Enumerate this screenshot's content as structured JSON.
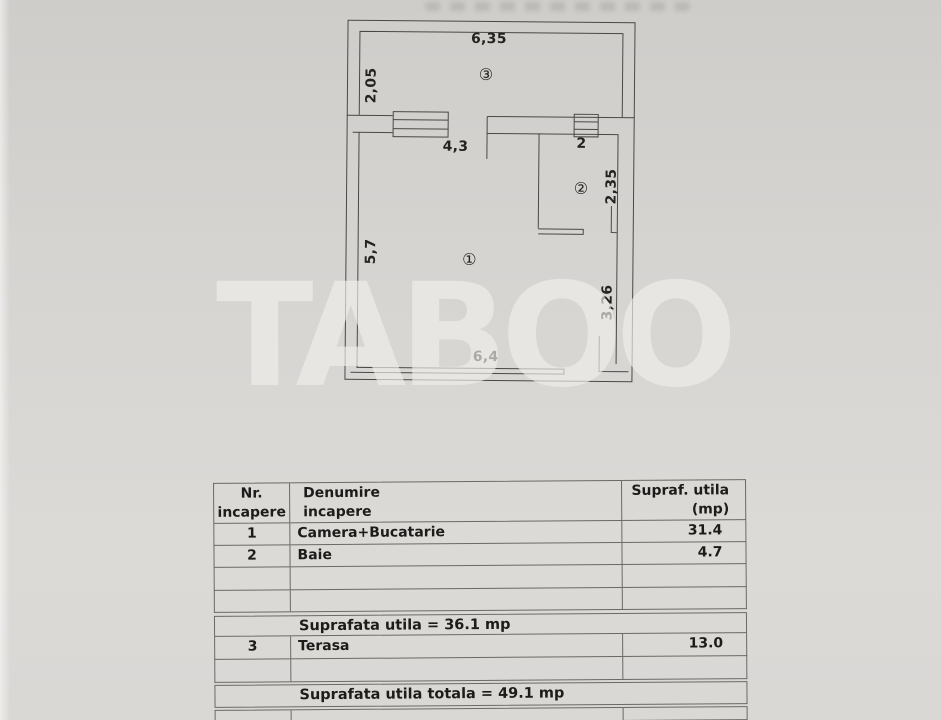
{
  "watermark": {
    "text": "TABOO"
  },
  "floor_plan": {
    "markers": {
      "room1": "①",
      "room2": "②",
      "room3": "③"
    },
    "dimensions": {
      "terrace_width": "6,35",
      "terrace_depth": "2,05",
      "window_wall": "4,3",
      "bath_width": "2",
      "bath_depth": "2,35",
      "room_depth": "5,7",
      "right_side": "3,26",
      "room_width": "6,4"
    }
  },
  "table": {
    "headers": {
      "nr": "Nr.\nincapere",
      "denumire": "Denumire\nincapere",
      "supraf": "Supraf. utila\n(mp)"
    },
    "rows": [
      {
        "nr": "1",
        "denumire": "Camera+Bucatarie",
        "supraf": "31.4"
      },
      {
        "nr": "2",
        "denumire": "Baie",
        "supraf": "4.7"
      },
      {
        "nr": "",
        "denumire": "",
        "supraf": ""
      },
      {
        "nr": "",
        "denumire": "",
        "supraf": ""
      }
    ],
    "subtotal": "Suprafata utila = 36.1 mp",
    "rows2": [
      {
        "nr": "3",
        "denumire": "Terasa",
        "supraf": "13.0"
      },
      {
        "nr": "",
        "denumire": "",
        "supraf": ""
      }
    ],
    "total": "Suprafata utila totala = 49.1 mp"
  }
}
